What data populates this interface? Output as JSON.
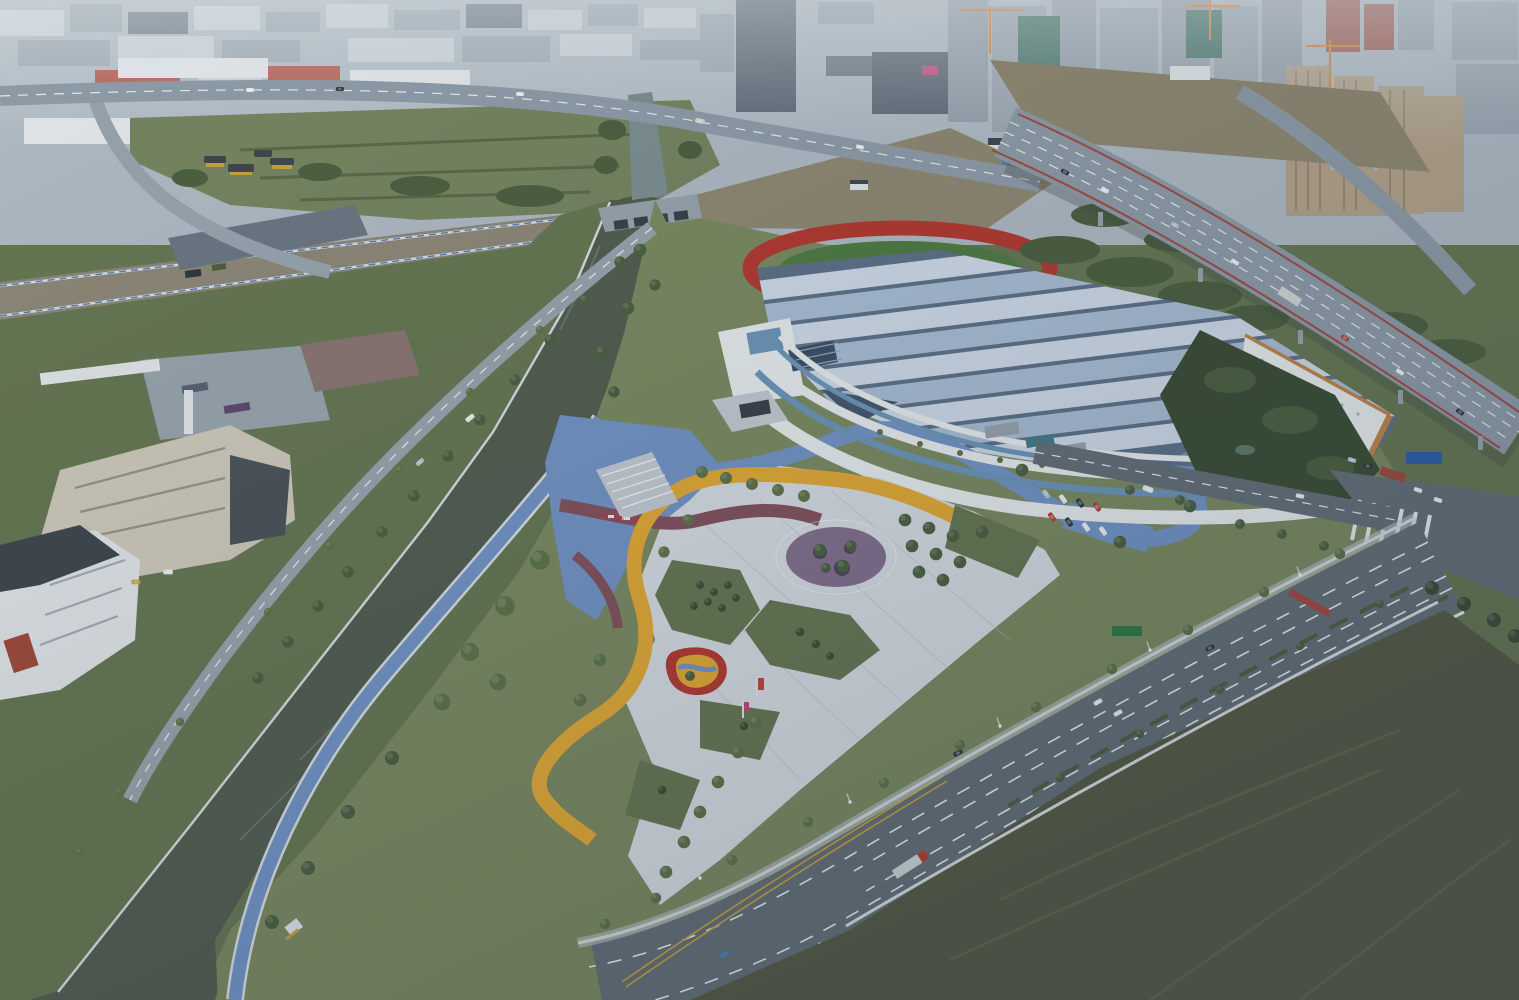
{
  "meta": {
    "kind": "aerial-photograph",
    "width": 1519,
    "height": 1000
  },
  "scene": {
    "landmarks": [
      "city-skyline",
      "high-rise-towers-under-construction",
      "elevated-expressway",
      "canal",
      "sluice-bridge",
      "riverside-greenway",
      "sports-center-wavy-roof",
      "running-track",
      "colorful-plaza",
      "playground",
      "parking-lot",
      "arterial-road",
      "intersection-crosswalks",
      "office-buildings",
      "bus-depot",
      "construction-corridor",
      "scrub-field"
    ]
  },
  "palette": {
    "haze": "#aeb9c2",
    "far_light": "#c9d1d7",
    "far_mid": "#99a5af",
    "far_dark": "#6a7682",
    "factory_red": "#b14f3e",
    "warehouse_white": "#e2e6e9",
    "tower_dark": "#57636f",
    "tower_gray": "#939ea9",
    "tower_tan": "#b3a289",
    "tower_red": "#a05a4e",
    "netting_green": "#3f6e62",
    "crane_orange": "#d57f2a",
    "billboard_pink": "#c04a7a",
    "field_green": "#75855f",
    "grass_light": "#7b8a60",
    "grass_mid": "#667752",
    "grass_dark": "#4e5f42",
    "tree_dark": "#3b4e35",
    "tree_mid": "#4c6040",
    "tree_light": "#5e7349",
    "water": "#535e50",
    "water_upper": "#7c8e91",
    "corridor_dirt": "#8d8776",
    "site_dirt": "#8f8871",
    "dirt_dark": "#565b45",
    "dirt_track": "#6b7054",
    "road_asphalt": "#646f77",
    "road_light": "#97a3ac",
    "highway_deck": "#8e9ca8",
    "lane_white": "#e6ebee",
    "lane_yellow": "#c8a23c",
    "stripe_red": "#a34a42",
    "fence_white": "#d8dee2",
    "fence_blue": "#4d7fb5",
    "paving_white": "#d7dce1",
    "paving_gray": "#c3cad1",
    "plaza_yellow": "#e2a934",
    "plaza_blue": "#7394c5",
    "plaza_maroon": "#82525c",
    "plaza_purple": "#83708d",
    "track_red": "#b23a2f",
    "infield_green": "#4f7b42",
    "roof_light": "#cfdae7",
    "roof_mid": "#a9bdd3",
    "roof_shadow": "#5d7188",
    "facade_white": "#e8eced",
    "glass_blue": "#6d95b8",
    "wood_orange": "#c08448",
    "bldg_beige": "#cec8ba",
    "bldg_white": "#e0e4e7",
    "bldg_dark": "#4b5359",
    "bldg_mauve": "#8a7672",
    "roof_slate": "#3f474d",
    "bldg_red": "#9e4a3a",
    "car_white": "#e9edef",
    "car_dark": "#2f363c",
    "car_red": "#b04038",
    "car_silver": "#b9c2c8",
    "truck_red": "#b5402f",
    "truck_box": "#cfd6d4",
    "pole_white": "#dde5e9",
    "banner_red": "#c24438",
    "sign_blue": "#2b5fa8",
    "sign_green": "#2f7a46"
  }
}
